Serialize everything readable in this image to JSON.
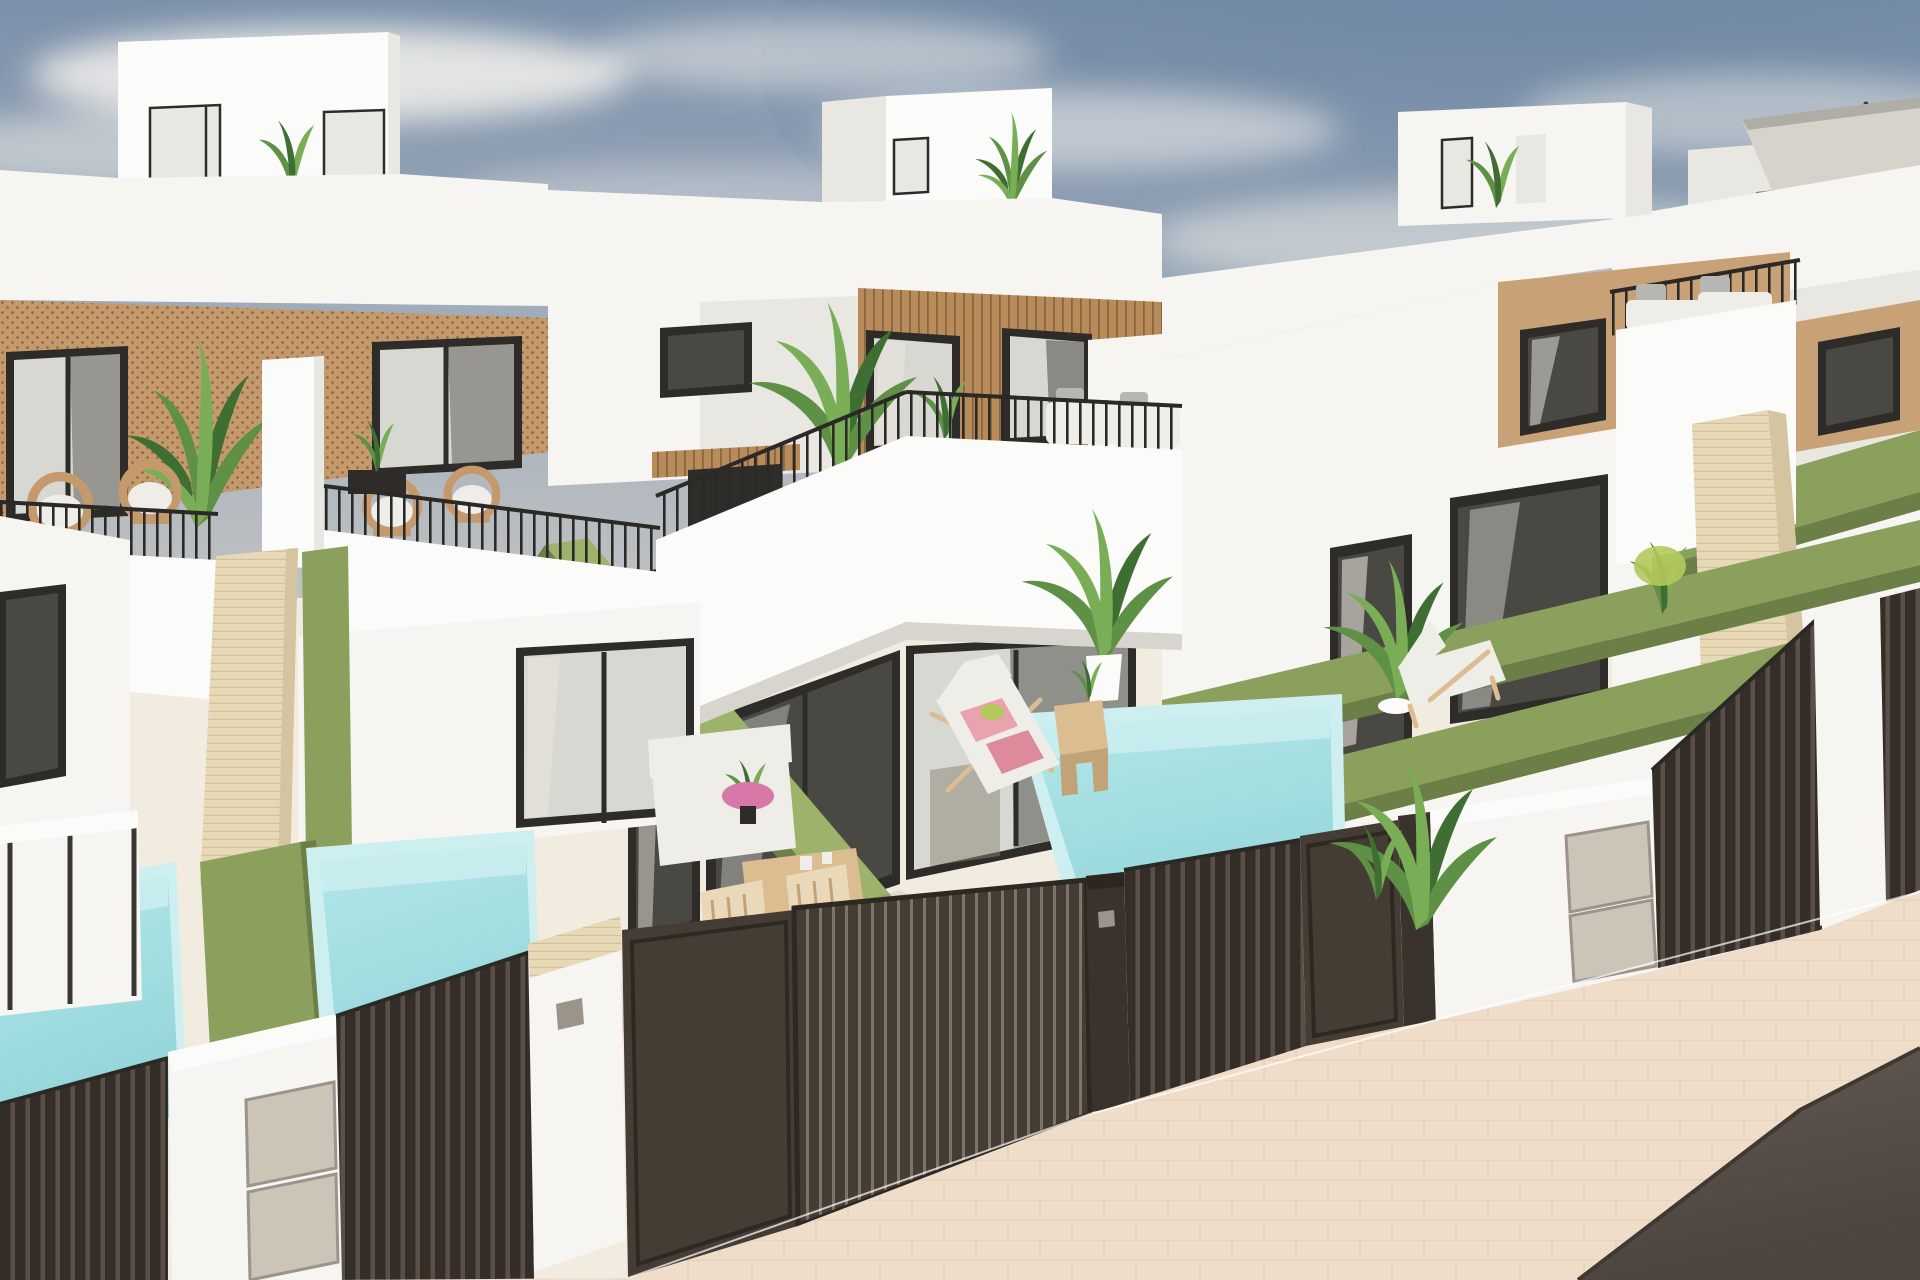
{
  "scene": {
    "type": "3d-architectural-render",
    "description": "Aerial three-quarter view of a row of modern white two-storey townhouse villas with flat roofs, rooftop access boxes, wood-slat facade accents, black-railed balconies with rattan furniture, artificial-grass-topped dividing walls, private turquoise plunge pools, travertine pillars, dark brown slatted street fences and sliding gates, a pale paved sidewalk and an asphalt street in the foreground under a hazy blue sky.",
    "visible_objects": [
      "sky with soft clouds",
      "four townhouse units receding to the right",
      "rooftop terrace boxes with doors and potted plants",
      "cantilever parasol on far-right roof terrace",
      "balconies with black metal railings",
      "rattan egg chairs with white cushions",
      "white outdoor sofas with gray pillows",
      "wood-slat and rattan facade cladding",
      "dark-framed sliding glass doors",
      "green artificial-grass boundary walls",
      "travertine stone pillars",
      "three turquoise plunge pools",
      "sun lounger with pink towels",
      "wooden side table and dining set with pink flowers",
      "dark brown slatted fences and gates",
      "white gate pillar with utility meter doors",
      "pale herringbone-paved sidewalk",
      "dark asphalt road"
    ],
    "units_visible": 4,
    "pools_visible": 3,
    "style": "contemporary Mediterranean new-build"
  },
  "palette": {
    "sky_top": "#7b90aa",
    "sky_mid": "#a2aebb",
    "sky_horizon": "#c9c8c5",
    "sky_deep": "#64809f",
    "cloud": "#f3f1ec",
    "wall_white": "#f6f5f2",
    "wall_bright": "#fbfbf9",
    "wall_shade": "#e9e7e2",
    "wall_dark": "#d8d5cf",
    "patio": "#f1ebe0",
    "patio_shade": "#e1d9ca",
    "rattan_base": "#c49a6c",
    "rattan_dot": "#8a6342",
    "wood_slat": "#b78b5a",
    "wood_groove": "#8a6540",
    "tan_panel": "#c9a177",
    "travertine": "#e7d8b6",
    "travertine_line": "#d2c19e",
    "travertine_shade": "#d5c4a0",
    "glass_frame": "#2e2c28",
    "glass_dark": "#4a4842",
    "glass_light": "#d7d8d2",
    "glass_reflect": "#eceee9",
    "curtain": "#e5e2da",
    "railing_dark": "#2b2926",
    "green_top": "#8aa05c",
    "green_bright": "#9db36b",
    "green_side": "#6c7f46",
    "plant_dark": "#3f6e33",
    "plant_mid": "#5e9046",
    "plant_light": "#79ae57",
    "plant_yellow": "#b4c95b",
    "pool_wall": "#cdeff0",
    "pool_light": "#b5e7e9",
    "pool_deep": "#8fd3d8",
    "sidewalk": "#efddc9",
    "sidewalk_line": "#ddc3a8",
    "road_dark": "#4c443d",
    "road_light": "#635a52",
    "fence_dark": "#3a332c",
    "fence_slat": "#352e28",
    "fence_gap": "#5a5047",
    "gate_metal": "#7d746a",
    "gate_panel": "#453c34",
    "meter_panel": "#cbc4b7",
    "meter_frame": "#9a948a",
    "cushion_white": "#efede8",
    "cushion_gray": "#dedcd6",
    "pillow_gray": "#b7b6b2",
    "towel_pink_1": "#eaa2ae",
    "towel_pink_2": "#dd8b9b",
    "flower_pink": "#d878a8",
    "wood_furn": "#dcbd92",
    "wood_furn_dark": "#c2a277",
    "chair_cream": "#ead9b8",
    "umbrella_canopy": "#d7d3cb",
    "umbrella_frame": "#3c3b38",
    "sofa_gray": "#75797c"
  }
}
